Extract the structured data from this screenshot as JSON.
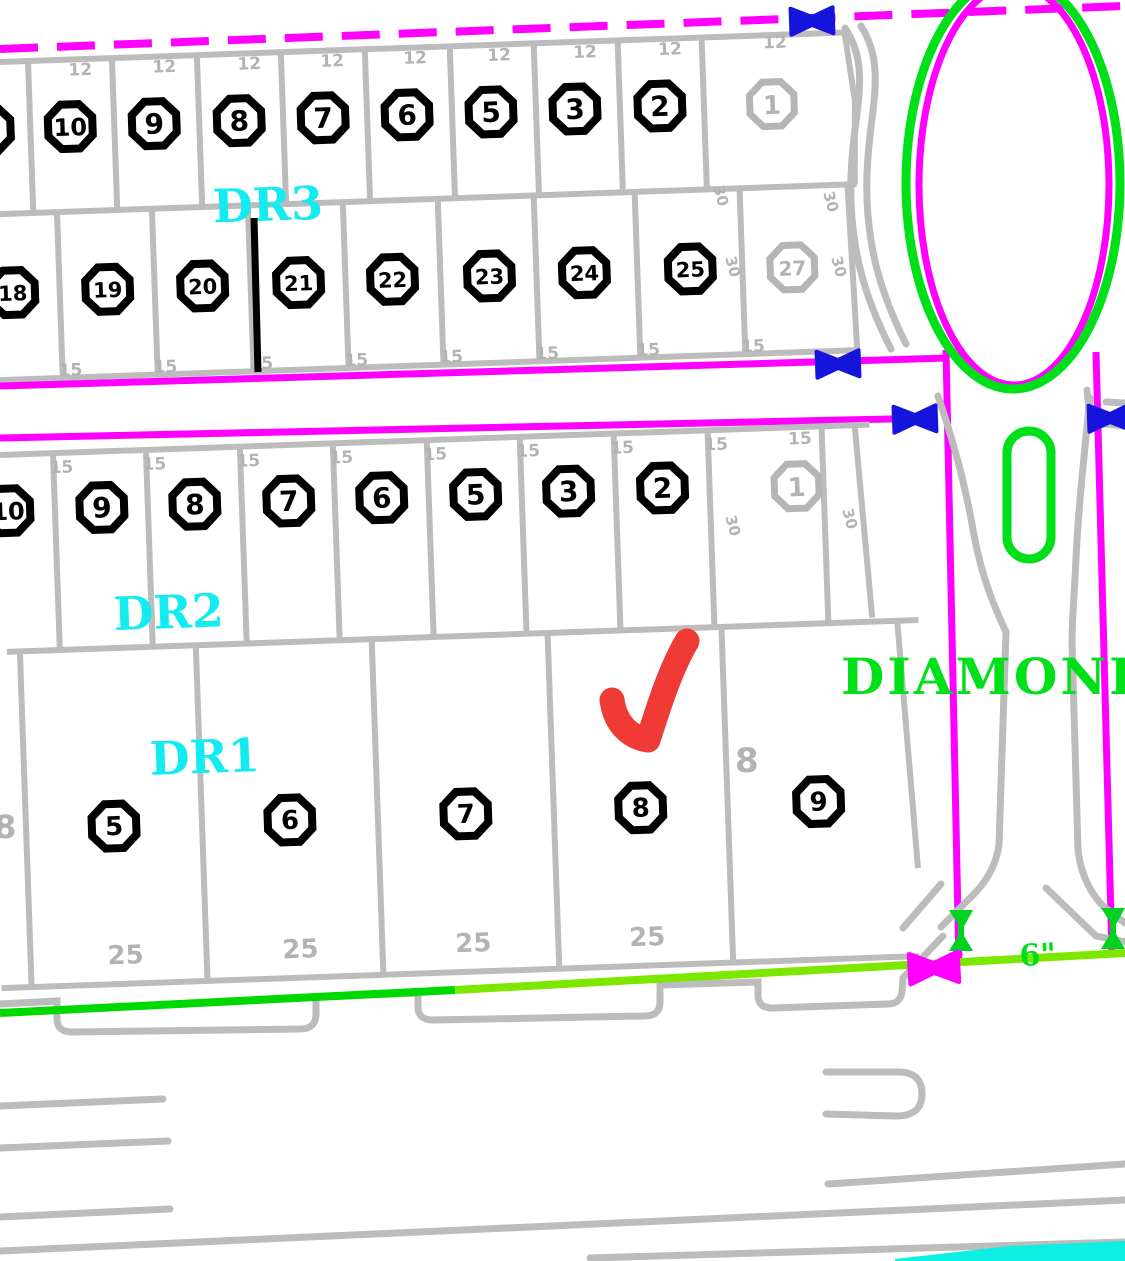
{
  "streets": {
    "dr1": "DR1",
    "dr2": "DR2",
    "dr3": "DR3",
    "diamond": "DIAMOND"
  },
  "labels": {
    "pipe_size": "6\""
  },
  "lot_markers": {
    "row_a": [
      "10",
      "9",
      "8",
      "7",
      "6",
      "5",
      "3",
      "2"
    ],
    "row_a_gray": "1",
    "row_b": [
      "18",
      "19",
      "20",
      "21",
      "22",
      "23",
      "24",
      "25"
    ],
    "row_b_gray": "27",
    "row_c": [
      "10",
      "9",
      "8",
      "7",
      "6",
      "5",
      "3",
      "2"
    ],
    "row_c_gray": "1",
    "row_d": [
      "5",
      "6",
      "7",
      "8",
      "9"
    ]
  },
  "dimensions": {
    "frontage": "25",
    "lot_width": "12",
    "lot_depth": "15",
    "side": "30",
    "eight": "8"
  },
  "colors": {
    "magenta": "#ff00ff",
    "blue_valve": "#1414dc",
    "cyan_label": "#12ecf0",
    "green": "#00e019",
    "green_line": "#00d900",
    "chartreuse": "#7ce800",
    "red_check": "#f03a36",
    "map_gray": "#bcbcbc",
    "cyan_band": "#0cf0e4"
  }
}
